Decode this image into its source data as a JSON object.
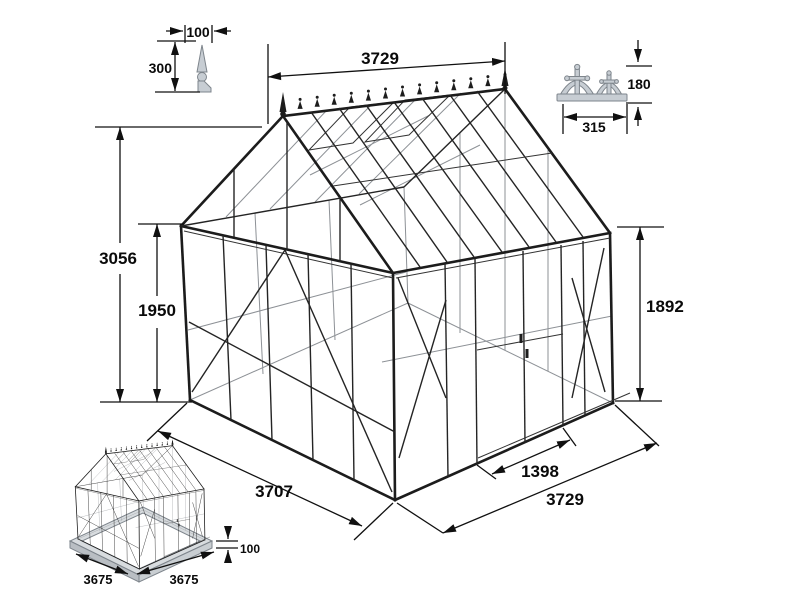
{
  "dimensions": {
    "ridge_length": "3729",
    "total_height": "3056",
    "eave_height": "1950",
    "side_wall_height": "1892",
    "gable_end_width": "3707",
    "door_opening_width": "1398",
    "side_wall_length": "3729"
  },
  "finial_detail": {
    "width": "100",
    "height": "300"
  },
  "cresting_detail": {
    "width": "315",
    "height": "180"
  },
  "base_inset": {
    "side_a": "3675",
    "side_b": "3675",
    "base_height": "100"
  },
  "colors": {
    "line": "#1c1c1c",
    "secondary_line": "#8d9196",
    "detail_fill": "#c7cdd3",
    "background": "#ffffff"
  }
}
